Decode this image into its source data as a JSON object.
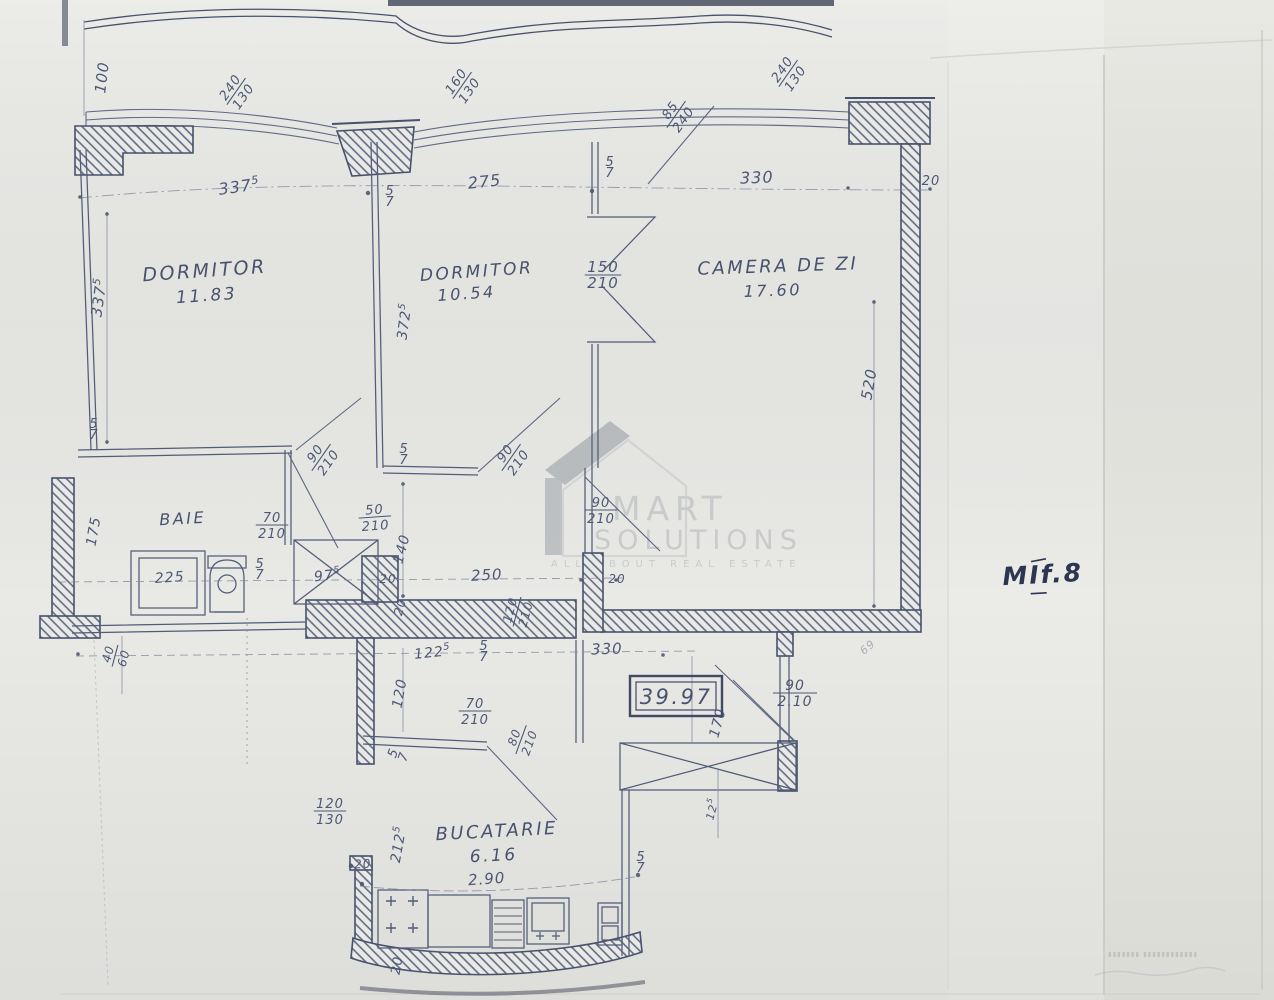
{
  "plan": {
    "type": "apartment-floor-plan-scan",
    "total_area_label": "39.97",
    "unit_note": "MIf.8",
    "rooms": [
      {
        "name": "DORMITOR",
        "area": "11.83"
      },
      {
        "name": "DORMITOR",
        "area": "10.54"
      },
      {
        "name": "CAMERA DE ZI",
        "area": "17.60"
      },
      {
        "name": "BAIE",
        "area": ""
      },
      {
        "name": "BUCATARIE",
        "area": "6.16"
      }
    ]
  },
  "watermark": {
    "line1": "MART",
    "line2": "SOLUTIONS",
    "line3": "ALL ABOUT REAL ESTATE",
    "house_icon": "house-logo",
    "gray": "#9aa0a6"
  },
  "stamp": {
    "microtext": "▮▮▮▮▮▮▮ ▮▮▮▮▮▮▮▮▮▮▮▮"
  },
  "colors": {
    "ink": "#4d5874",
    "paper": "#e9e9e6",
    "watermark": "#b5b9bc",
    "note_ink": "#2c3552"
  },
  "dimensions": [
    {
      "type": "plain",
      "text": "100",
      "x": 107,
      "y": 78,
      "rot": -83,
      "size": 15
    },
    {
      "type": "frac",
      "top": "240",
      "bottom": "130",
      "x": 237,
      "y": 92,
      "rot": -55
    },
    {
      "type": "frac",
      "top": "160",
      "bottom": "130",
      "x": 463,
      "y": 86,
      "rot": -55
    },
    {
      "type": "frac",
      "top": "85",
      "bottom": "240",
      "x": 677,
      "y": 115,
      "rot": -55
    },
    {
      "type": "frac",
      "top": "240",
      "bottom": "130",
      "x": 789,
      "y": 74,
      "rot": -55
    },
    {
      "type": "plain",
      "text": "337",
      "sup": "5",
      "x": 240,
      "y": 192,
      "rot": -8,
      "size": 16
    },
    {
      "type": "plain",
      "text": "275",
      "x": 485,
      "y": 187,
      "rot": -6,
      "size": 16
    },
    {
      "type": "plain",
      "text": "330",
      "x": 757,
      "y": 183,
      "rot": -2,
      "size": 16
    },
    {
      "type": "plain",
      "text": "20",
      "x": 931,
      "y": 185,
      "rot": 0,
      "size": 13
    },
    {
      "type": "stack",
      "top": "5",
      "bottom": "7",
      "x": 610,
      "y": 168,
      "rot": 0
    },
    {
      "type": "stack",
      "top": "5",
      "bottom": "7",
      "x": 390,
      "y": 197,
      "rot": 0
    },
    {
      "type": "plain",
      "text": "337",
      "sup": "5",
      "x": 104,
      "y": 298,
      "rot": -82,
      "size": 15
    },
    {
      "type": "stack",
      "top": "5",
      "bottom": "7",
      "x": 94,
      "y": 430,
      "rot": 0
    },
    {
      "type": "plain",
      "text": "372",
      "sup": "5",
      "x": 409,
      "y": 322,
      "rot": -82,
      "size": 14
    },
    {
      "type": "frac",
      "top": "150",
      "bottom": "210",
      "x": 603,
      "y": 276,
      "rot": 0,
      "size": 15
    },
    {
      "type": "plain",
      "text": "520",
      "x": 874,
      "y": 385,
      "rot": -80,
      "size": 15
    },
    {
      "type": "frac",
      "top": "90",
      "bottom": "210",
      "x": 322,
      "y": 458,
      "rot": -55
    },
    {
      "type": "stack",
      "top": "5",
      "bottom": "7",
      "x": 404,
      "y": 455,
      "rot": 0
    },
    {
      "type": "frac",
      "top": "90",
      "bottom": "210",
      "x": 512,
      "y": 458,
      "rot": -55
    },
    {
      "type": "frac",
      "top": "50",
      "bottom": "210",
      "x": 375,
      "y": 518,
      "rot": -4
    },
    {
      "type": "plain",
      "text": "140",
      "x": 406,
      "y": 550,
      "rot": -75,
      "size": 14
    },
    {
      "type": "frac",
      "top": "90",
      "bottom": "210",
      "x": 601,
      "y": 511,
      "rot": 0
    },
    {
      "type": "plain",
      "text": "175",
      "x": 98,
      "y": 532,
      "rot": -80,
      "size": 14
    },
    {
      "type": "frac",
      "top": "70",
      "bottom": "210",
      "x": 272,
      "y": 526,
      "rot": 0
    },
    {
      "type": "plain",
      "text": "225",
      "x": 170,
      "y": 582,
      "rot": -4,
      "size": 14
    },
    {
      "type": "stack",
      "top": "5",
      "bottom": "7",
      "x": 260,
      "y": 570,
      "rot": 0
    },
    {
      "type": "plain",
      "text": "97",
      "sup": "5",
      "x": 328,
      "y": 580,
      "rot": -6,
      "size": 14
    },
    {
      "type": "plain",
      "text": "20",
      "x": 388,
      "y": 583,
      "rot": 0,
      "size": 12
    },
    {
      "type": "plain",
      "text": "250",
      "x": 487,
      "y": 580,
      "rot": -3,
      "size": 15
    },
    {
      "type": "plain",
      "text": "20",
      "x": 404,
      "y": 608,
      "rot": -75,
      "size": 12
    },
    {
      "type": "frac",
      "top": "120",
      "bottom": "210",
      "x": 518,
      "y": 612,
      "rot": -75,
      "size": 12
    },
    {
      "type": "plain",
      "text": "20",
      "x": 617,
      "y": 583,
      "rot": 0,
      "size": 12
    },
    {
      "type": "frac",
      "top": "40",
      "bottom": "60",
      "x": 116,
      "y": 656,
      "rot": -75,
      "size": 12
    },
    {
      "type": "plain",
      "text": "330",
      "x": 607,
      "y": 654,
      "rot": -2,
      "size": 15
    },
    {
      "type": "plain",
      "text": "170",
      "x": 722,
      "y": 724,
      "rot": -75,
      "size": 14
    },
    {
      "type": "frac",
      "top": "90",
      "bottom": "2.10",
      "x": 795,
      "y": 694,
      "rot": 0,
      "size": 14
    },
    {
      "type": "plain",
      "text": "12",
      "sup": "5",
      "x": 716,
      "y": 810,
      "rot": -75,
      "size": 11
    },
    {
      "type": "plain",
      "text": "122",
      "sup": "5",
      "x": 433,
      "y": 657,
      "rot": -6,
      "size": 14
    },
    {
      "type": "stack",
      "top": "5",
      "bottom": "7",
      "x": 484,
      "y": 652,
      "rot": 0
    },
    {
      "type": "plain",
      "text": "120",
      "x": 404,
      "y": 694,
      "rot": -80,
      "size": 14
    },
    {
      "type": "frac",
      "top": "70",
      "bottom": "210",
      "x": 475,
      "y": 712,
      "rot": 0
    },
    {
      "type": "frac",
      "top": "80",
      "bottom": "210",
      "x": 522,
      "y": 740,
      "rot": -70,
      "size": 12
    },
    {
      "type": "stack",
      "top": "5",
      "bottom": "7",
      "x": 399,
      "y": 755,
      "rot": -70
    },
    {
      "type": "frac",
      "top": "120",
      "bottom": "130",
      "x": 330,
      "y": 812,
      "rot": 0
    },
    {
      "type": "plain",
      "text": "212",
      "sup": "5",
      "x": 403,
      "y": 845,
      "rot": -80,
      "size": 14
    },
    {
      "type": "plain",
      "text": "2.90",
      "x": 487,
      "y": 884,
      "rot": -4,
      "size": 15
    },
    {
      "type": "plain",
      "text": "20",
      "x": 363,
      "y": 868,
      "rot": -3,
      "size": 12
    },
    {
      "type": "plain",
      "text": "20",
      "x": 401,
      "y": 966,
      "rot": -80,
      "size": 13
    },
    {
      "type": "stack",
      "top": "5",
      "bottom": "7",
      "x": 641,
      "y": 863,
      "rot": 0
    },
    {
      "type": "plain",
      "text": "69",
      "x": 870,
      "y": 650,
      "rot": -40,
      "size": 11,
      "faint": true
    }
  ]
}
